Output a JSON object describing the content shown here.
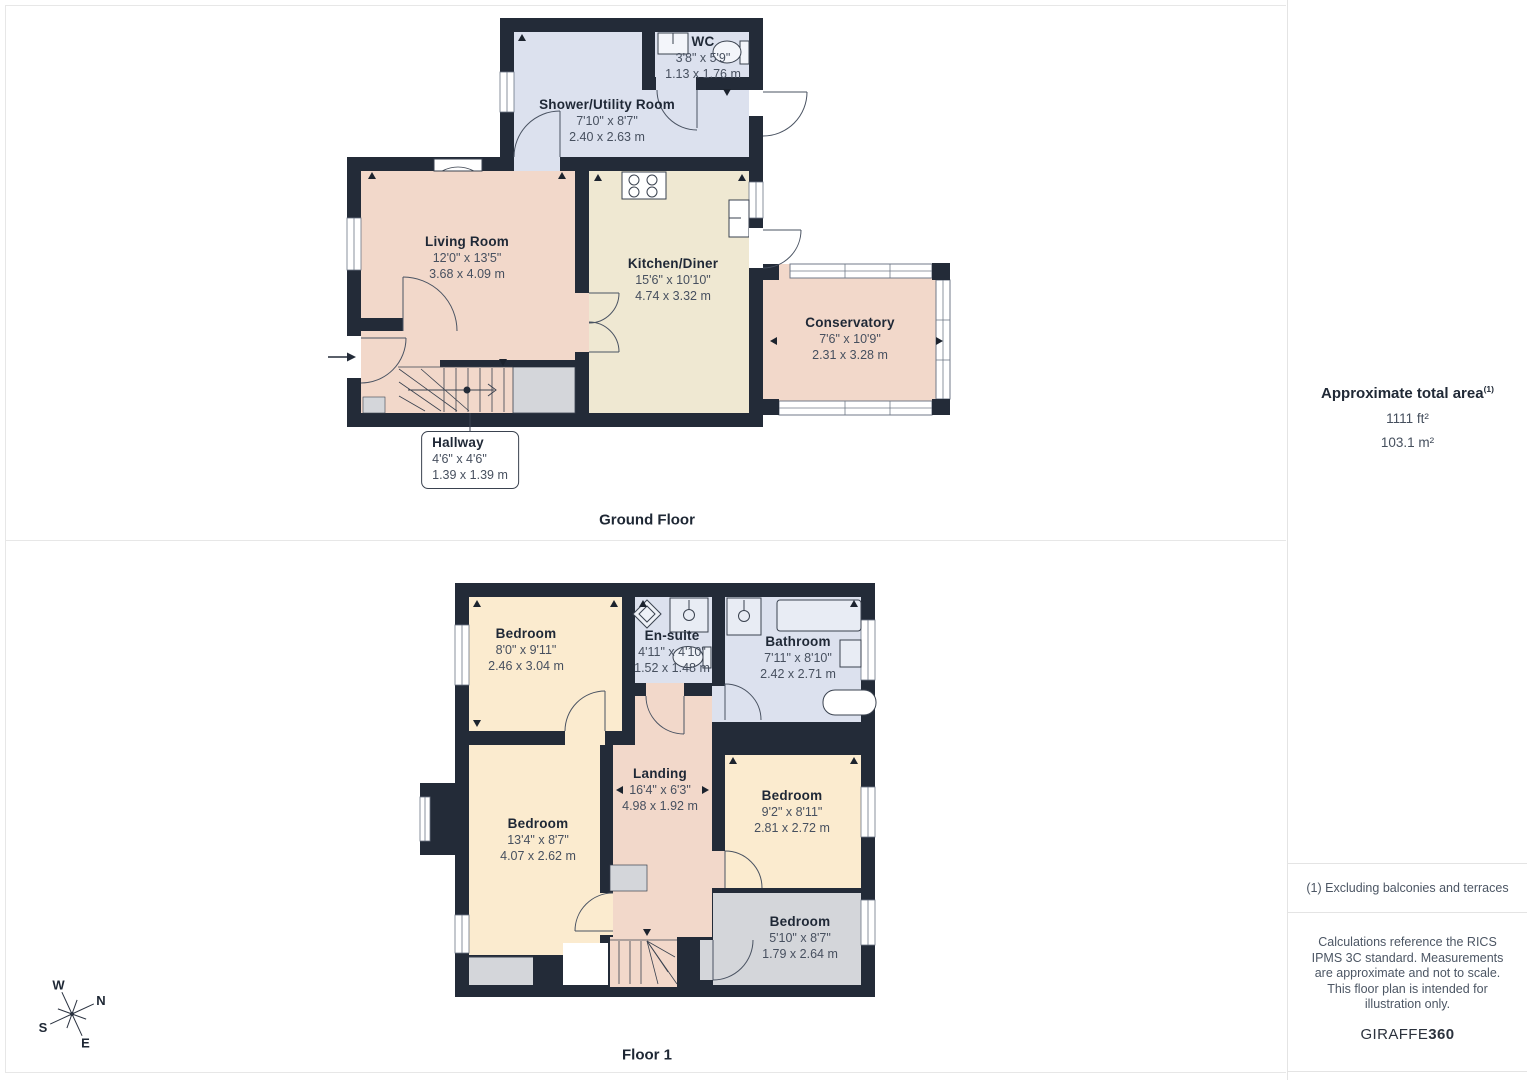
{
  "ground": {
    "title": "Ground Floor",
    "rooms": [
      {
        "name": "WC",
        "imperial": "3'8\" x 5'9\"",
        "metric": "1.13 x 1.76 m"
      },
      {
        "name": "Shower/Utility Room",
        "imperial": "7'10\" x 8'7\"",
        "metric": "2.40 x 2.63 m"
      },
      {
        "name": "Living Room",
        "imperial": "12'0\" x 13'5\"",
        "metric": "3.68 x 4.09 m"
      },
      {
        "name": "Kitchen/Diner",
        "imperial": "15'6\" x 10'10\"",
        "metric": "4.74 x 3.32 m"
      },
      {
        "name": "Conservatory",
        "imperial": "7'6\" x 10'9\"",
        "metric": "2.31 x 3.28 m"
      },
      {
        "name": "Hallway",
        "imperial": "4'6\" x 4'6\"",
        "metric": "1.39 x 1.39 m"
      }
    ]
  },
  "floor1": {
    "title": "Floor 1",
    "rooms": [
      {
        "name": "Bedroom",
        "imperial": "8'0\" x 9'11\"",
        "metric": "2.46 x 3.04 m"
      },
      {
        "name": "En-suite",
        "imperial": "4'11\" x 4'10\"",
        "metric": "1.52 x 1.48 m"
      },
      {
        "name": "Bathroom",
        "imperial": "7'11\" x 8'10\"",
        "metric": "2.42 x 2.71 m"
      },
      {
        "name": "Landing",
        "imperial": "16'4\" x 6'3\"",
        "metric": "4.98 x 1.92 m"
      },
      {
        "name": "Bedroom",
        "imperial": "13'4\" x 8'7\"",
        "metric": "4.07 x 2.62 m"
      },
      {
        "name": "Bedroom",
        "imperial": "9'2\" x 8'11\"",
        "metric": "2.81 x 2.72 m"
      },
      {
        "name": "Bedroom",
        "imperial": "5'10\" x 8'7\"",
        "metric": "1.79 x 2.64 m"
      }
    ]
  },
  "sidebar": {
    "area_title": "Approximate total area",
    "area_footnote_marker": "(1)",
    "area_imperial": "1111 ft²",
    "area_metric": "103.1 m²",
    "footnote": "(1) Excluding balconies and terraces",
    "disclaimer": "Calculations reference the RICS IPMS 3C standard. Measurements are approximate and not to scale. This floor plan is intended for illustration only.",
    "brand_name": "GIRAFFE",
    "brand_number": "360"
  },
  "compass": {
    "north": "N",
    "east": "E",
    "south": "S",
    "west": "W"
  },
  "colors": {
    "wall": "#232b38",
    "room_pink": "#f2d8ca",
    "room_cream": "#efe8d2",
    "room_blue": "#dce1ee",
    "room_peach": "#fbebcf",
    "room_gray": "#d4d6da",
    "panel_border": "#e7e7e7"
  }
}
